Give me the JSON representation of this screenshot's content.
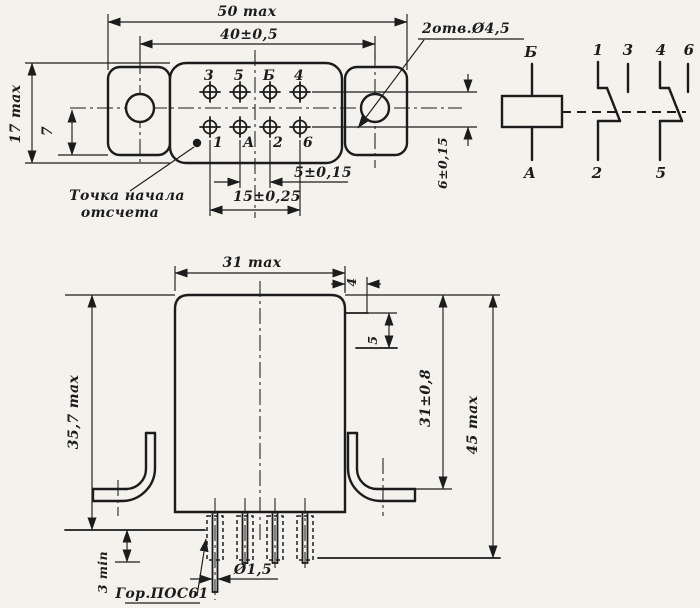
{
  "top_view": {
    "dim_total_width": "50 max",
    "dim_hole_spacing": "40±0,5",
    "holes_note": "2отв.Ø4,5",
    "dim_height": "17 max",
    "dim_row_offset": "7",
    "dim_pin_pitch": "5±0,15",
    "dim_pin_span": "15±0,25",
    "dim_row_gap": "6±0,15",
    "ref_note_line1": "Точка начала",
    "ref_note_line2": "отсчета",
    "pins_top": [
      "3",
      "5",
      "Б",
      "4"
    ],
    "pins_bottom": [
      "1",
      "А",
      "2",
      "6"
    ]
  },
  "schematic": {
    "coil_top": "Б",
    "coil_bottom": "А",
    "group1": {
      "top_left": "1",
      "top_right": "3",
      "bottom": "2"
    },
    "group2": {
      "top_left": "4",
      "top_right": "6",
      "bottom": "5"
    }
  },
  "front_view": {
    "dim_width": "31 max",
    "dim_body_height": "35,7 max",
    "dim_total_height": "45 max",
    "dim_mount_height": "31±0,8",
    "dim_tab_offset": "4",
    "dim_tab_drop": "5",
    "dim_pin_clearance": "3 min",
    "dim_pin_diameter": "Ø1,5",
    "solder_note": "Гор.ПОС61"
  },
  "colors": {
    "ink": "#1c1c1c",
    "paper": "#f4f2ec"
  }
}
